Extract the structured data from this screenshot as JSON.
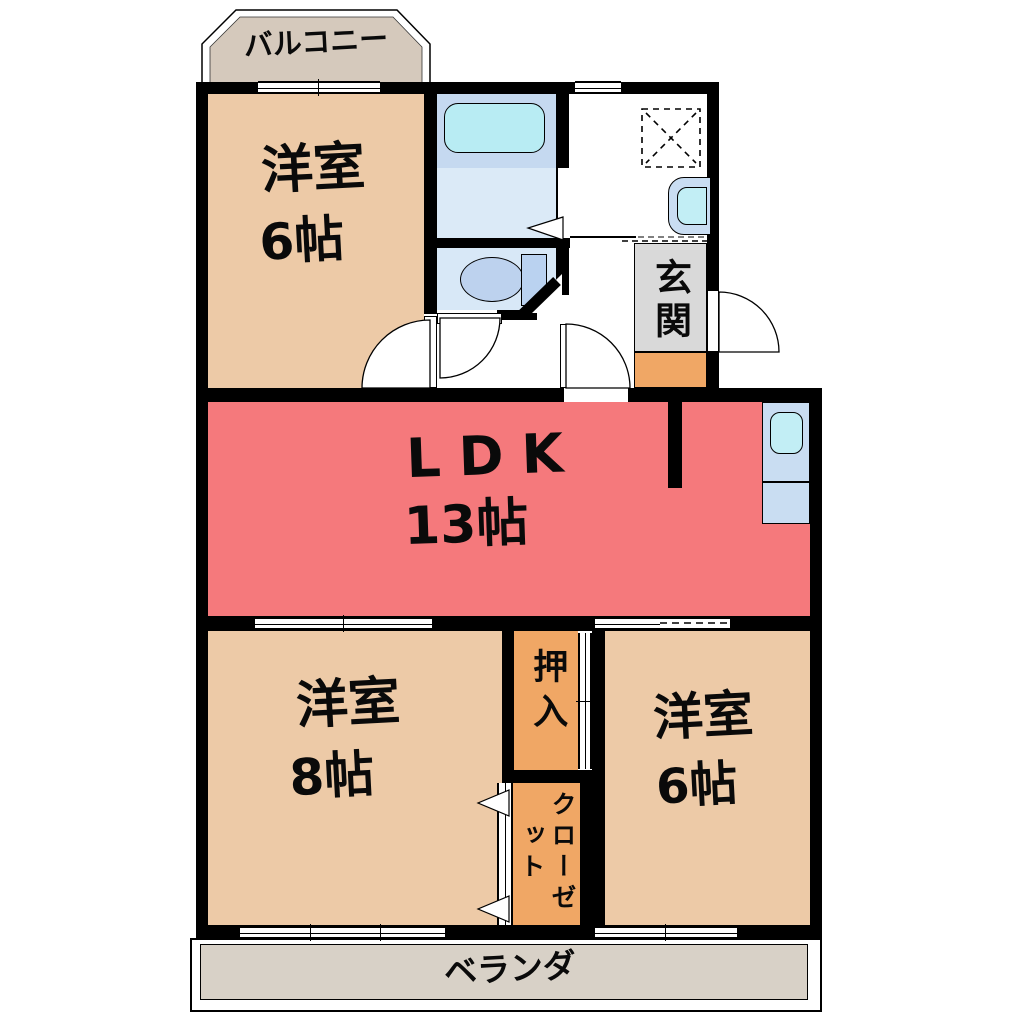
{
  "rooms": {
    "balcony": {
      "label": "バルコニー"
    },
    "bedroom_top_left": {
      "label": "洋室",
      "size": "6帖"
    },
    "ldk": {
      "label": "LDK",
      "size": "13帖"
    },
    "bedroom_bottom_left": {
      "label": "洋室",
      "size": "8帖"
    },
    "bedroom_bottom_right": {
      "label": "洋室",
      "size": "6帖"
    },
    "entrance": {
      "label": "玄関"
    },
    "oshiire": {
      "label": "押入"
    },
    "closet": {
      "label": "クローゼット"
    },
    "veranda": {
      "label": "ベランダ"
    }
  },
  "colors": {
    "wall": "#000000",
    "room-tan": "#edcaa7",
    "ldk-salmon": "#f5797c",
    "closet-orange": "#f0a765",
    "entrance-gray": "#d9d9d9",
    "step-orange": "#f0a765",
    "balcony-fill": "#d5c9bc",
    "veranda-fill": "#d8d1c7",
    "bath-blue": "#c5d9f0",
    "washroom-blue": "#dbeaf7",
    "toilet-blue": "#d8e8f7",
    "tub-cyan": "#b8ecf3",
    "fixture-blue": "#bdd2ee",
    "tank-blue": "#bad2f0",
    "counter-blue": "#c9ddf2",
    "sink-cyan": "#c2eef5"
  }
}
